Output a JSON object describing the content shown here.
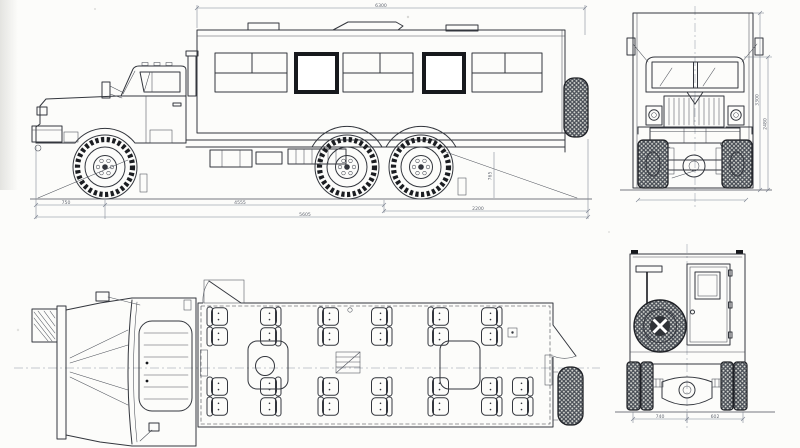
{
  "page": {
    "background": "#fcfcfa",
    "ink": "#33363d",
    "dim_color": "#79818f",
    "window_frame_color": "#17191d"
  },
  "drawing": {
    "subject": "off-road-truck-crew-bus-blueprint",
    "views": [
      {
        "id": "side-view",
        "position": "top-left"
      },
      {
        "id": "front-view",
        "position": "top-right"
      },
      {
        "id": "plan-view",
        "position": "bottom-left",
        "seat_count": 26,
        "tables": 2
      },
      {
        "id": "rear-view",
        "position": "bottom-right"
      }
    ],
    "dimensions": {
      "body_length_top": "6300",
      "front_overhang": "750",
      "wheelbase": "4555",
      "overall_length": "5605",
      "rear_section": "2200",
      "rear_frame_height": "765",
      "front_height": "3300",
      "front_cab_height": "2480",
      "rear_track_left": "740",
      "rear_track_right": "602"
    }
  }
}
